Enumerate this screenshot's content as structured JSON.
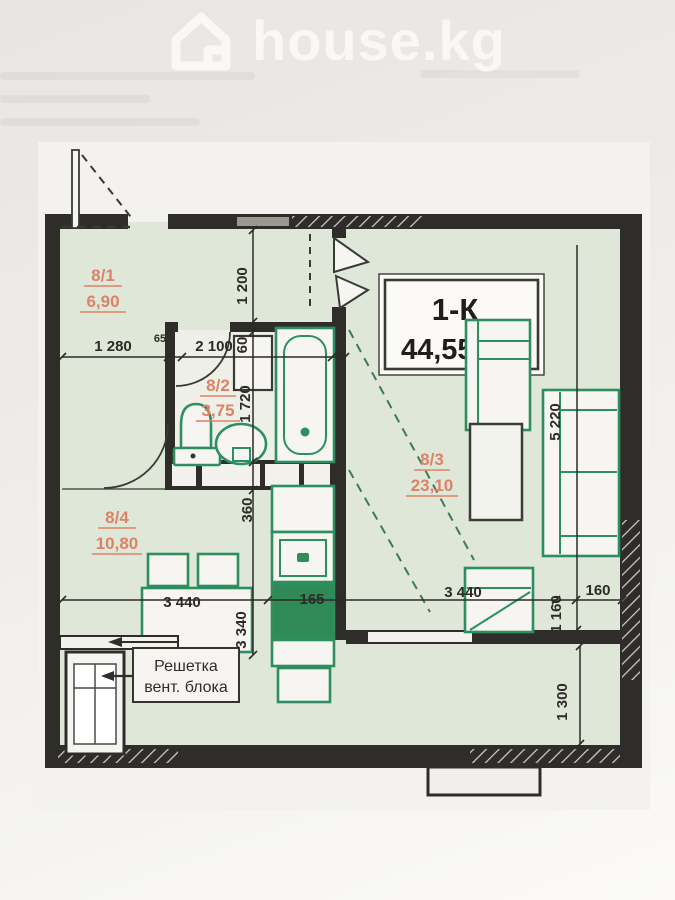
{
  "header": {
    "brand": "house.kg"
  },
  "plan": {
    "title_type": "1-К",
    "title_area": "44,55м",
    "title_area_sup": "2",
    "rooms": [
      {
        "id": "8/1",
        "area": "6,90"
      },
      {
        "id": "8/2",
        "area": "3,75"
      },
      {
        "id": "8/3",
        "area": "23,10"
      },
      {
        "id": "8/4",
        "area": "10,80"
      }
    ],
    "dims": {
      "d1280": "1 280",
      "d65": "65",
      "d2100": "2 100",
      "d60": "60",
      "d1200": "1 200",
      "d1720": "1 720",
      "d360": "360",
      "d3340": "3 340",
      "d3440_left": "3 440",
      "d165": "165",
      "d3440_right": "3 440",
      "d160": "160",
      "d1160": "1 160",
      "d5220": "5 220",
      "d1300": "1 300"
    },
    "vent": {
      "line1": "Решетка",
      "line2": "вент. блока"
    },
    "colors": {
      "fixture_green": "#2e8f5e",
      "room_label_orange": "#dd8266",
      "floor_green": "#dfe7d8",
      "wall_dark": "#2e2d29"
    }
  }
}
